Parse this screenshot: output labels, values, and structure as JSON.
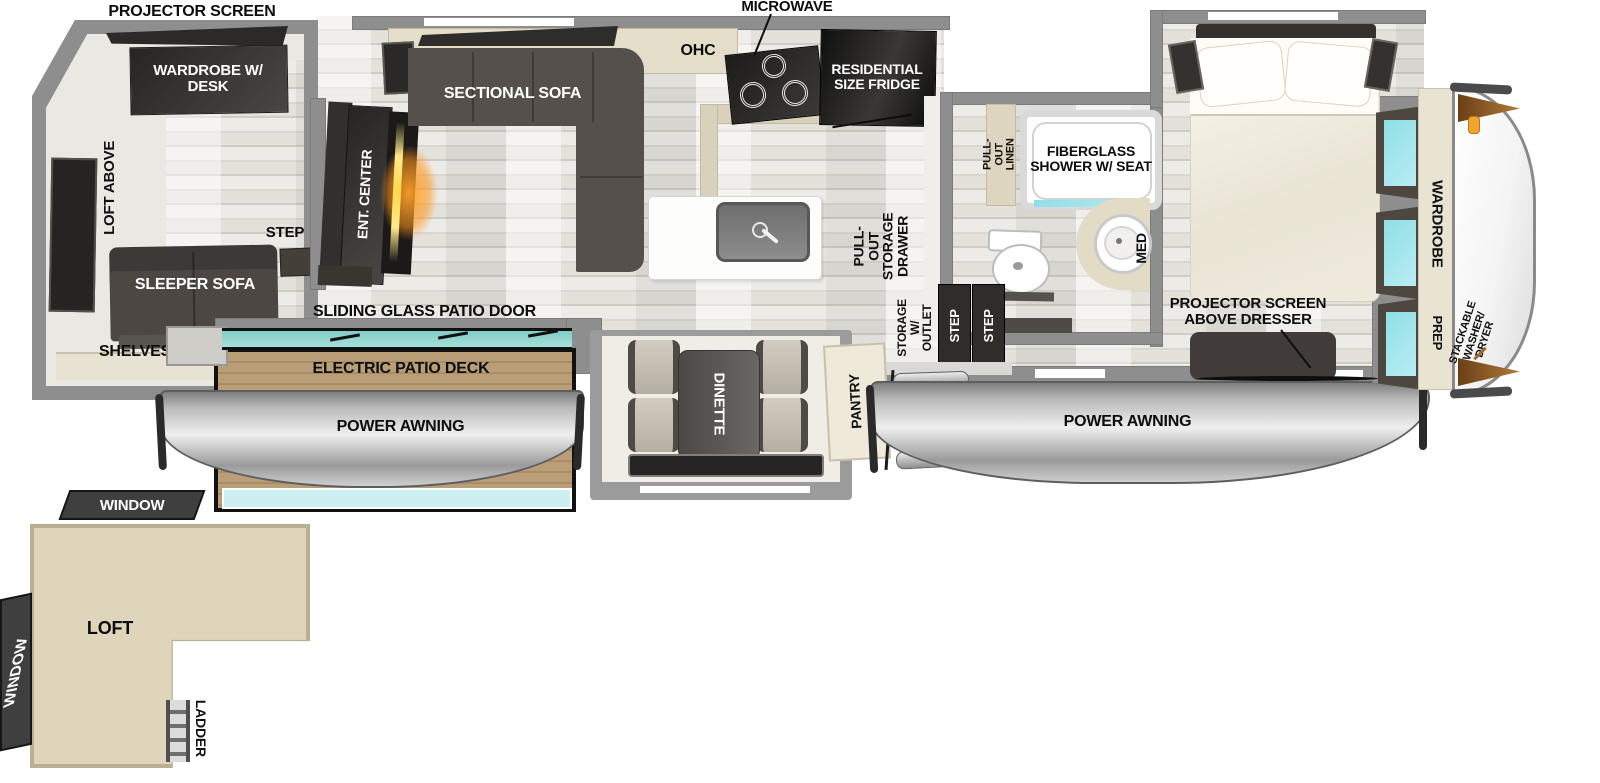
{
  "plan": {
    "title": "RV fifth-wheel floor plan",
    "labels": {
      "projector_screen": "PROJECTOR SCREEN",
      "microwave": "MICROWAVE",
      "wardrobe_desk": "WARDROBE W/ DESK",
      "loft_above": "LOFT ABOVE",
      "ent_center": "ENT. CENTER",
      "step_rear": "STEP",
      "sectional_sofa": "SECTIONAL SOFA",
      "ohc": "OHC",
      "residential_fridge": "RESIDENTIAL SIZE FRIDGE",
      "pull_out_storage_drawer": "PULL-OUT STORAGE DRAWER",
      "sleeper_sofa": "SLEEPER SOFA",
      "shelves": "SHELVES",
      "sliding_glass_patio_door": "SLIDING GLASS PATIO DOOR",
      "electric_patio_deck": "ELECTRIC PATIO DECK",
      "power_awning_left": "POWER AWNING",
      "power_awning_right": "POWER AWNING",
      "dinette": "DINETTE",
      "pantry": "PANTRY",
      "storage_w_outlet": "STORAGE W/ OUTLET",
      "step_entry_1": "STEP",
      "step_entry_2": "STEP",
      "pull_out_linen": "PULL-OUT LINEN",
      "fiberglass_shower": "FIBERGLASS SHOWER W/ SEAT",
      "med": "MED",
      "projector_screen_dresser": "PROJECTOR SCREEN ABOVE DRESSER",
      "wardrobe": "WARDROBE",
      "prep": "PREP",
      "stackable_washer_dryer": "STACKABLE WASHER/ DRYER",
      "window_rear_top": "WINDOW",
      "window_rear_side": "WINDOW",
      "loft": "LOFT",
      "ladder": "LADDER"
    },
    "colors": {
      "wall_gray": "#8e8e8e",
      "floor_light": "#e7e5e0",
      "dark_furniture": "#45413e",
      "cabinet_beige": "#ddd6c2",
      "loft_beige": "#ddd4b9",
      "window_cyan": "#9ce4ea",
      "deck_wood": "#b2976f",
      "awning_gray": "#c2c2c2",
      "flame_orange": "#ff9a1f",
      "cap_accent_brown": "#8a5a28"
    }
  }
}
